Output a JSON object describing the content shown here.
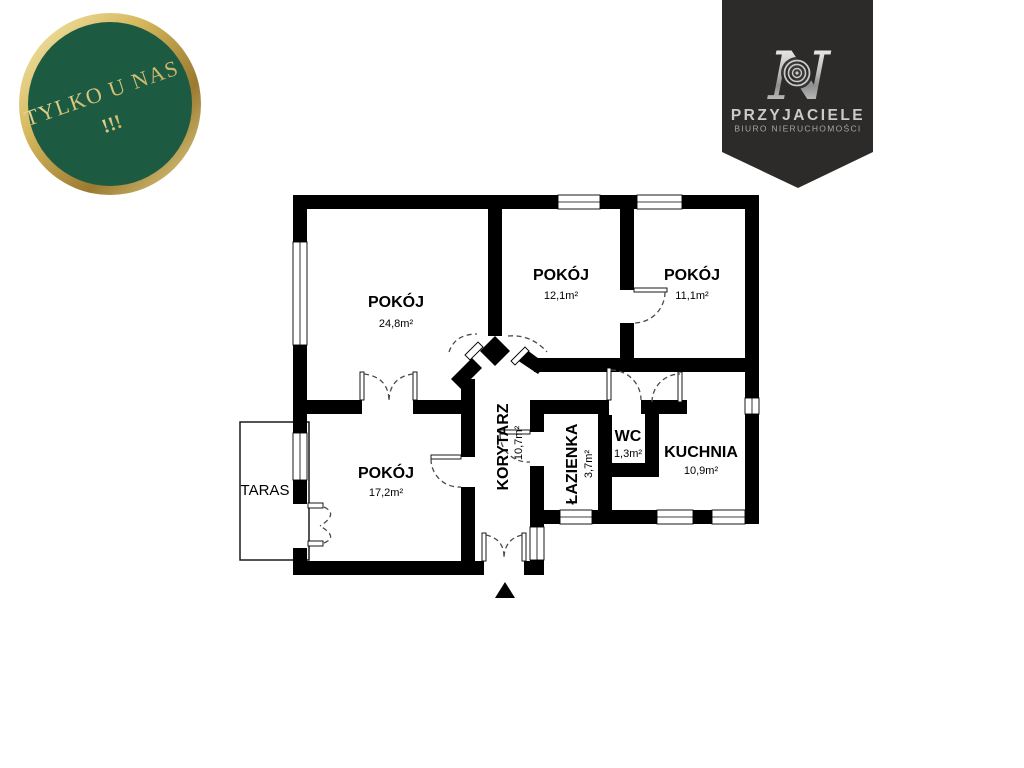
{
  "badge": {
    "line1": "TYLKO U NAS",
    "line2": "!!!",
    "bg_color": "#1d5a42",
    "ring_gold": "#c9a84c",
    "text_gold": "#d6c67e"
  },
  "brand": {
    "logo_letter": "N",
    "name": "PRZYJACIELE",
    "subtitle": "BIURO NIERUCHOMOŚCI",
    "ribbon_color": "#2c2b2a",
    "name_color": "#cbcbcb",
    "subtitle_color": "#a5a5a5"
  },
  "floor_plan": {
    "wall_color": "#000000",
    "door_arc_color": "#4a4a4a",
    "rooms": [
      {
        "id": "pokoj-1",
        "name": "POKÓJ",
        "area": "24,8m²"
      },
      {
        "id": "pokoj-2",
        "name": "POKÓJ",
        "area": "12,1m²"
      },
      {
        "id": "pokoj-3",
        "name": "POKÓJ",
        "area": "11,1m²"
      },
      {
        "id": "pokoj-4",
        "name": "POKÓJ",
        "area": "17,2m²"
      },
      {
        "id": "korytarz",
        "name": "KORYTARZ",
        "area": "10,7m²"
      },
      {
        "id": "lazienka",
        "name": "ŁAZIENKA",
        "area": "3,7m²"
      },
      {
        "id": "wc",
        "name": "WC",
        "area": "1,3m²"
      },
      {
        "id": "kuchnia",
        "name": "KUCHNIA",
        "area": "10,9m²"
      },
      {
        "id": "taras",
        "name": "TARAS",
        "area": ""
      }
    ]
  }
}
